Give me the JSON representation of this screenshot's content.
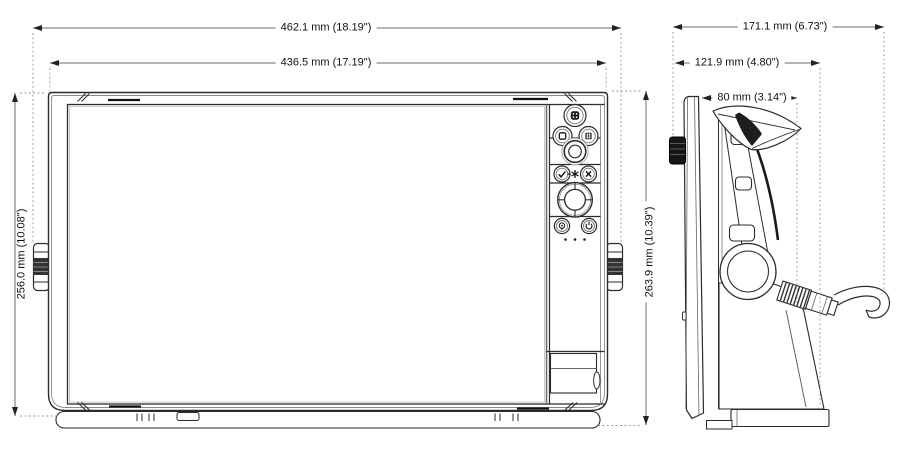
{
  "drawing": {
    "title": "multifunction-display-dimension-drawing",
    "views": {
      "front": "front-view",
      "side": "side-view"
    },
    "dimensions": {
      "overall_width": "462.1 mm (18.19\")",
      "bezel_width": "436.5 mm (17.19\")",
      "bezel_height": "256.0 mm (10.08\")",
      "overall_height": "263.9 mm (10.39\")",
      "overall_depth": "171.1 mm (6.73\")",
      "bracket_depth": "121.9 mm (4.80\")",
      "body_depth": "80 mm (3.14\")"
    },
    "keypad": {
      "buttons": [
        "pages",
        "windows",
        "menu",
        "rotary-knob",
        "enter",
        "standby-star",
        "exit",
        "cursor-pad",
        "mob",
        "power"
      ],
      "status_dots": 3
    },
    "colors": {
      "line": "#2b2b2b",
      "secondary_line": "#888888",
      "dimension_line": "#6b6b6b",
      "extension_line": "#9a9a9a",
      "text": "#111111",
      "background": "#ffffff"
    }
  }
}
